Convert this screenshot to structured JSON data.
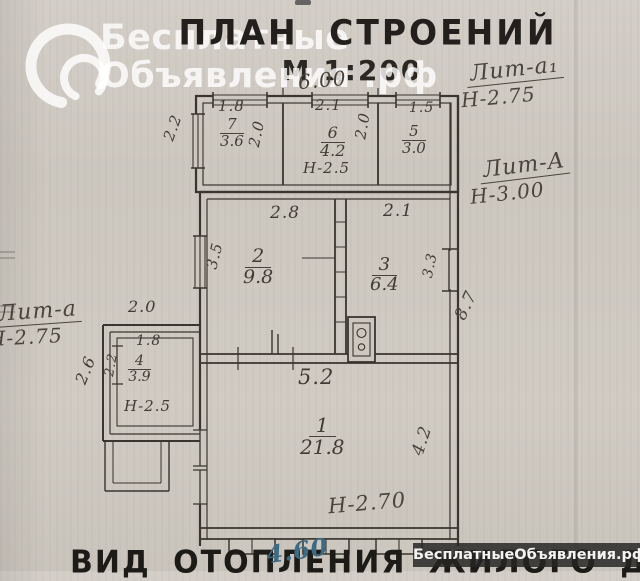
{
  "watermark": {
    "line1": "Бесплатные",
    "line2": "Объявления .рф"
  },
  "header": {
    "title": "ПЛАН СТРОЕНИЙ",
    "scale": "М 1:200"
  },
  "handwritten": {
    "top_width": "6.00",
    "lit_a1_label": "Лит-а₁",
    "lit_a1_height": "Н-2.75",
    "lit_A_label": "Лит-А",
    "lit_A_height": "Н-3.00",
    "lit_a_label": "Лит-а",
    "lit_a_height": "Н-2.75",
    "depth_right": "8.7",
    "room1_width": "4.2",
    "room1_height": "Н-2.70",
    "bottom_note": "4.60"
  },
  "plan": {
    "rooms": {
      "r7": {
        "num": "7",
        "area": "3.6"
      },
      "r6": {
        "num": "6",
        "area": "4.2"
      },
      "r5": {
        "num": "5",
        "area": "3.0"
      },
      "r2": {
        "num": "2",
        "area": "9.8"
      },
      "r3": {
        "num": "3",
        "area": "6.4"
      },
      "r4": {
        "num": "4",
        "area": "3.9"
      },
      "r1": {
        "num": "1",
        "area": "21.8"
      }
    },
    "dims": {
      "d18_top": "1.8",
      "d21_top": "2.1",
      "d15_top": "1.5",
      "d20_r7": "2.0",
      "d20_r6": "2.0",
      "d22_left": "2.2",
      "d28": "2.8",
      "d21_r3": "2.1",
      "d35": "3.5",
      "d33": "3.3",
      "d52": "5.2",
      "d20_annex": "2.0",
      "d18_annex": "1.8",
      "d22_annex": "2.2",
      "d26_annex": "2.6",
      "h25_r6": "Н-2.5",
      "h25_r4": "Н-2.5"
    }
  },
  "bottom": {
    "caption": "ВИД ОТОПЛЕНИЯ ЖИЛОГО ДОМА",
    "badge": "БесплатныеОбъявления.рф"
  }
}
